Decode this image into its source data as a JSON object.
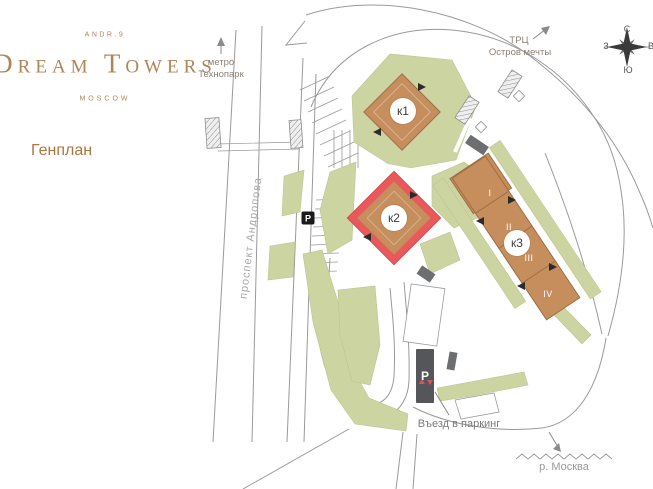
{
  "brand": {
    "tagline": "ANDR.9",
    "name": "Dream Towers",
    "city": "MOSCOW"
  },
  "page_title": "Генплан",
  "labels": {
    "metro_line1": "метро",
    "metro_line2": "Технопарк",
    "mall_line1": "ТРЦ",
    "mall_line2": "Остров мечты",
    "street": "проспект Андропова",
    "parking_entrance": "Въезд в паркинг",
    "river": "р. Москва"
  },
  "compass": {
    "north": "С",
    "east": "В",
    "south": "Ю",
    "west": "З"
  },
  "buildings": {
    "k1": {
      "label": "к1"
    },
    "k2": {
      "label": "к2",
      "highlighted": true
    },
    "k3": {
      "label": "к3",
      "sections": [
        "I",
        "II",
        "III",
        "IV"
      ]
    }
  },
  "parking": {
    "marker": "P",
    "garage": "P"
  },
  "colors": {
    "brand": "#b28557",
    "building_fill": "#c68d5d",
    "highlight_border": "#e8595c",
    "green": "#ccd4a2",
    "dark_structure": "#58595b",
    "road_line": "#9a9a9a"
  }
}
